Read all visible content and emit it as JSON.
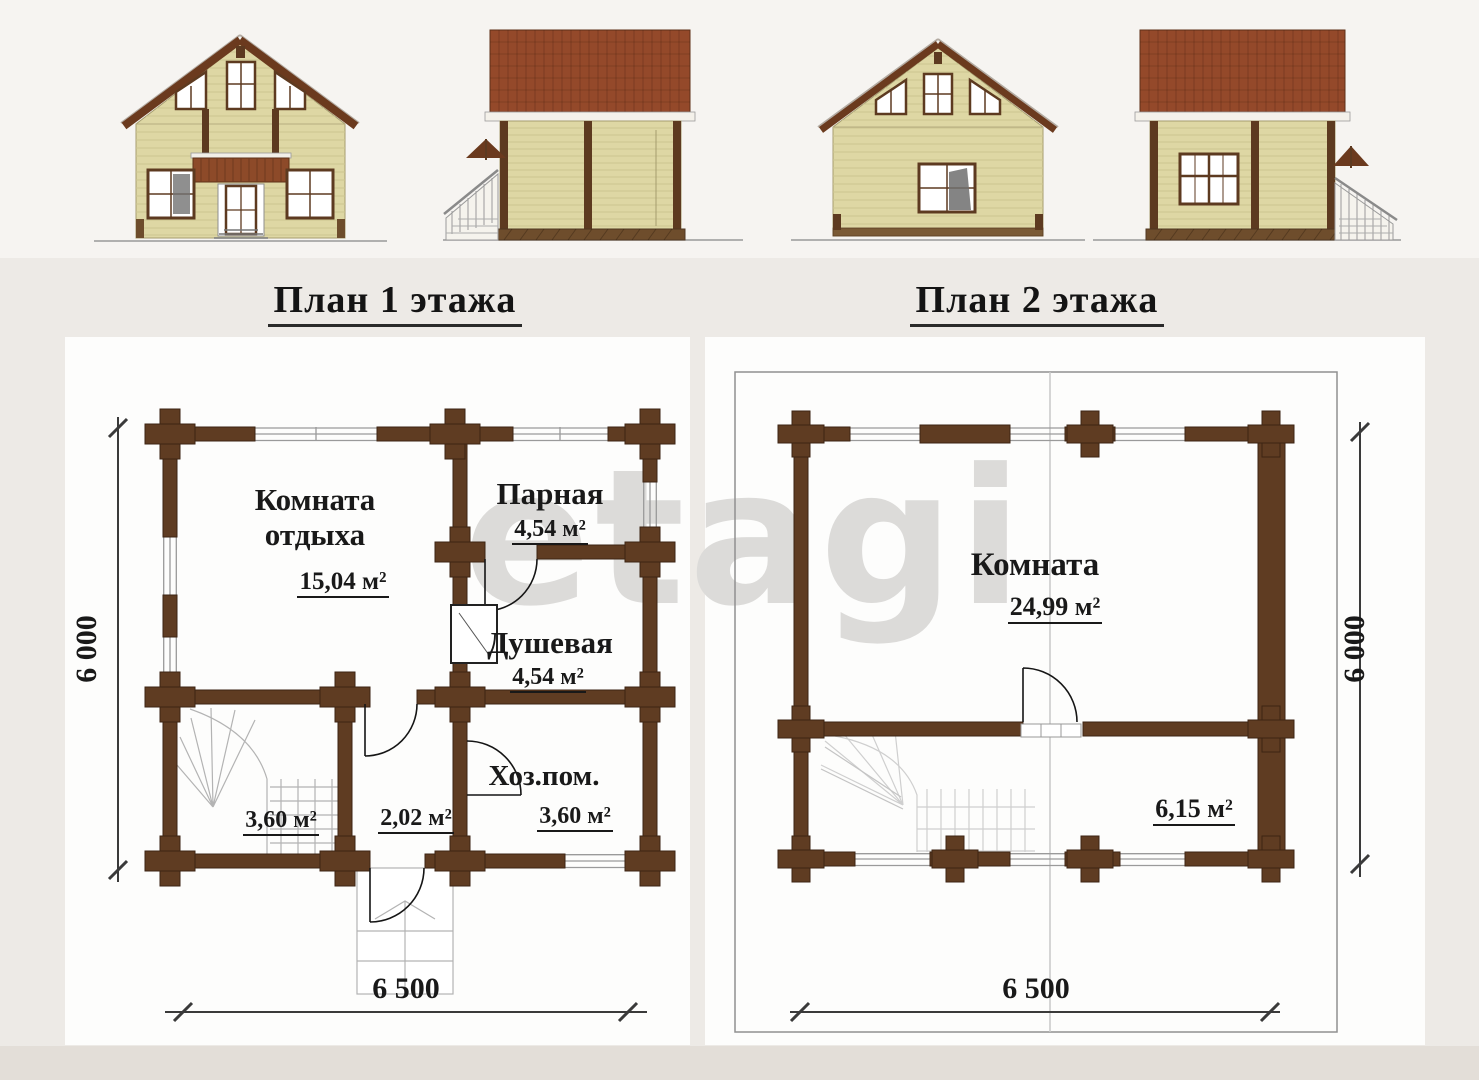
{
  "titles": {
    "plan1": "План 1 этажа",
    "plan2": "План 2 этажа"
  },
  "watermark": "etagi",
  "header": {
    "elevations": [
      "front-elevation",
      "side-elevation-stairs-left",
      "rear-elevation",
      "side-elevation-stairs-right"
    ]
  },
  "plan1": {
    "rooms": {
      "lounge": {
        "name": "Комната отдыха",
        "area": "15,04 м²"
      },
      "steam": {
        "name": "Парная",
        "area": "4,54 м²"
      },
      "shower": {
        "name": "Душевая",
        "area": "4,54 м²"
      },
      "utility": {
        "name": "Хоз.пом.",
        "area": "3,60 м²"
      },
      "stairs": {
        "area": "3,60 м²"
      },
      "hall": {
        "area": "2,02 м²"
      }
    },
    "dim_width": "6 500",
    "dim_height": "6 000"
  },
  "plan2": {
    "rooms": {
      "room": {
        "name": "Комната",
        "area": "24,99 м²"
      },
      "landing": {
        "area": "6,15 м²"
      }
    },
    "dim_width": "6 500",
    "dim_height": "6 000"
  },
  "colors": {
    "wall_brown": "#5f3c22",
    "roof_brown": "#94492a",
    "siding_khaki": "#ded7a4",
    "watermark_grey": "#dcdbd9"
  }
}
